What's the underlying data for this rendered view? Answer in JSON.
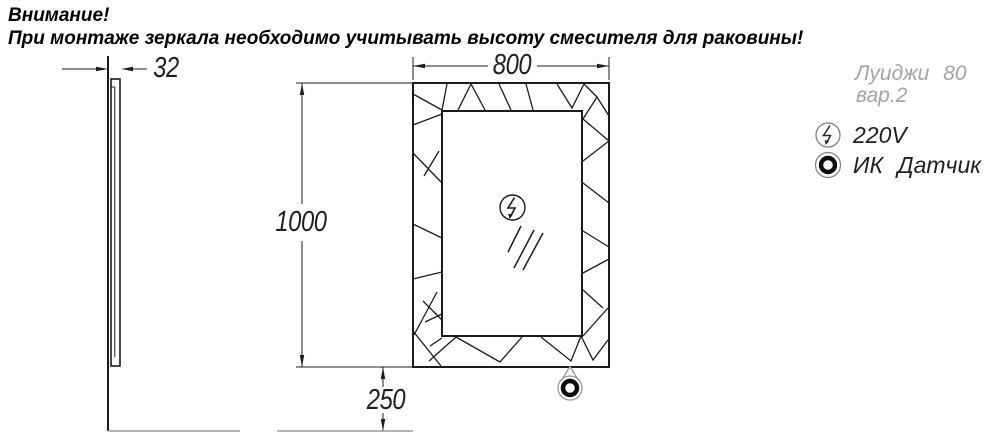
{
  "header": {
    "line1": "Внимание!",
    "line2": "При монтаже зеркала необходимо учитывать высоту смесителя для раковины!"
  },
  "dimensions": {
    "width_mm": "800",
    "height_mm": "1000",
    "depth_mm": "32",
    "bottom_offset_mm": "250"
  },
  "legend": {
    "model_name": "Луиджи 80",
    "model_variant": "вар.2",
    "power_label": "220V",
    "ir_sensor_label": "ИК Датчик"
  },
  "icons": {
    "power": "lightning-in-circle-icon",
    "ir_sensor": "bold-ring-in-circle-icon"
  },
  "colors": {
    "line": "#1c1c1c",
    "reference_line": "#9a9a9a",
    "model_text": "#a3a3a3"
  }
}
